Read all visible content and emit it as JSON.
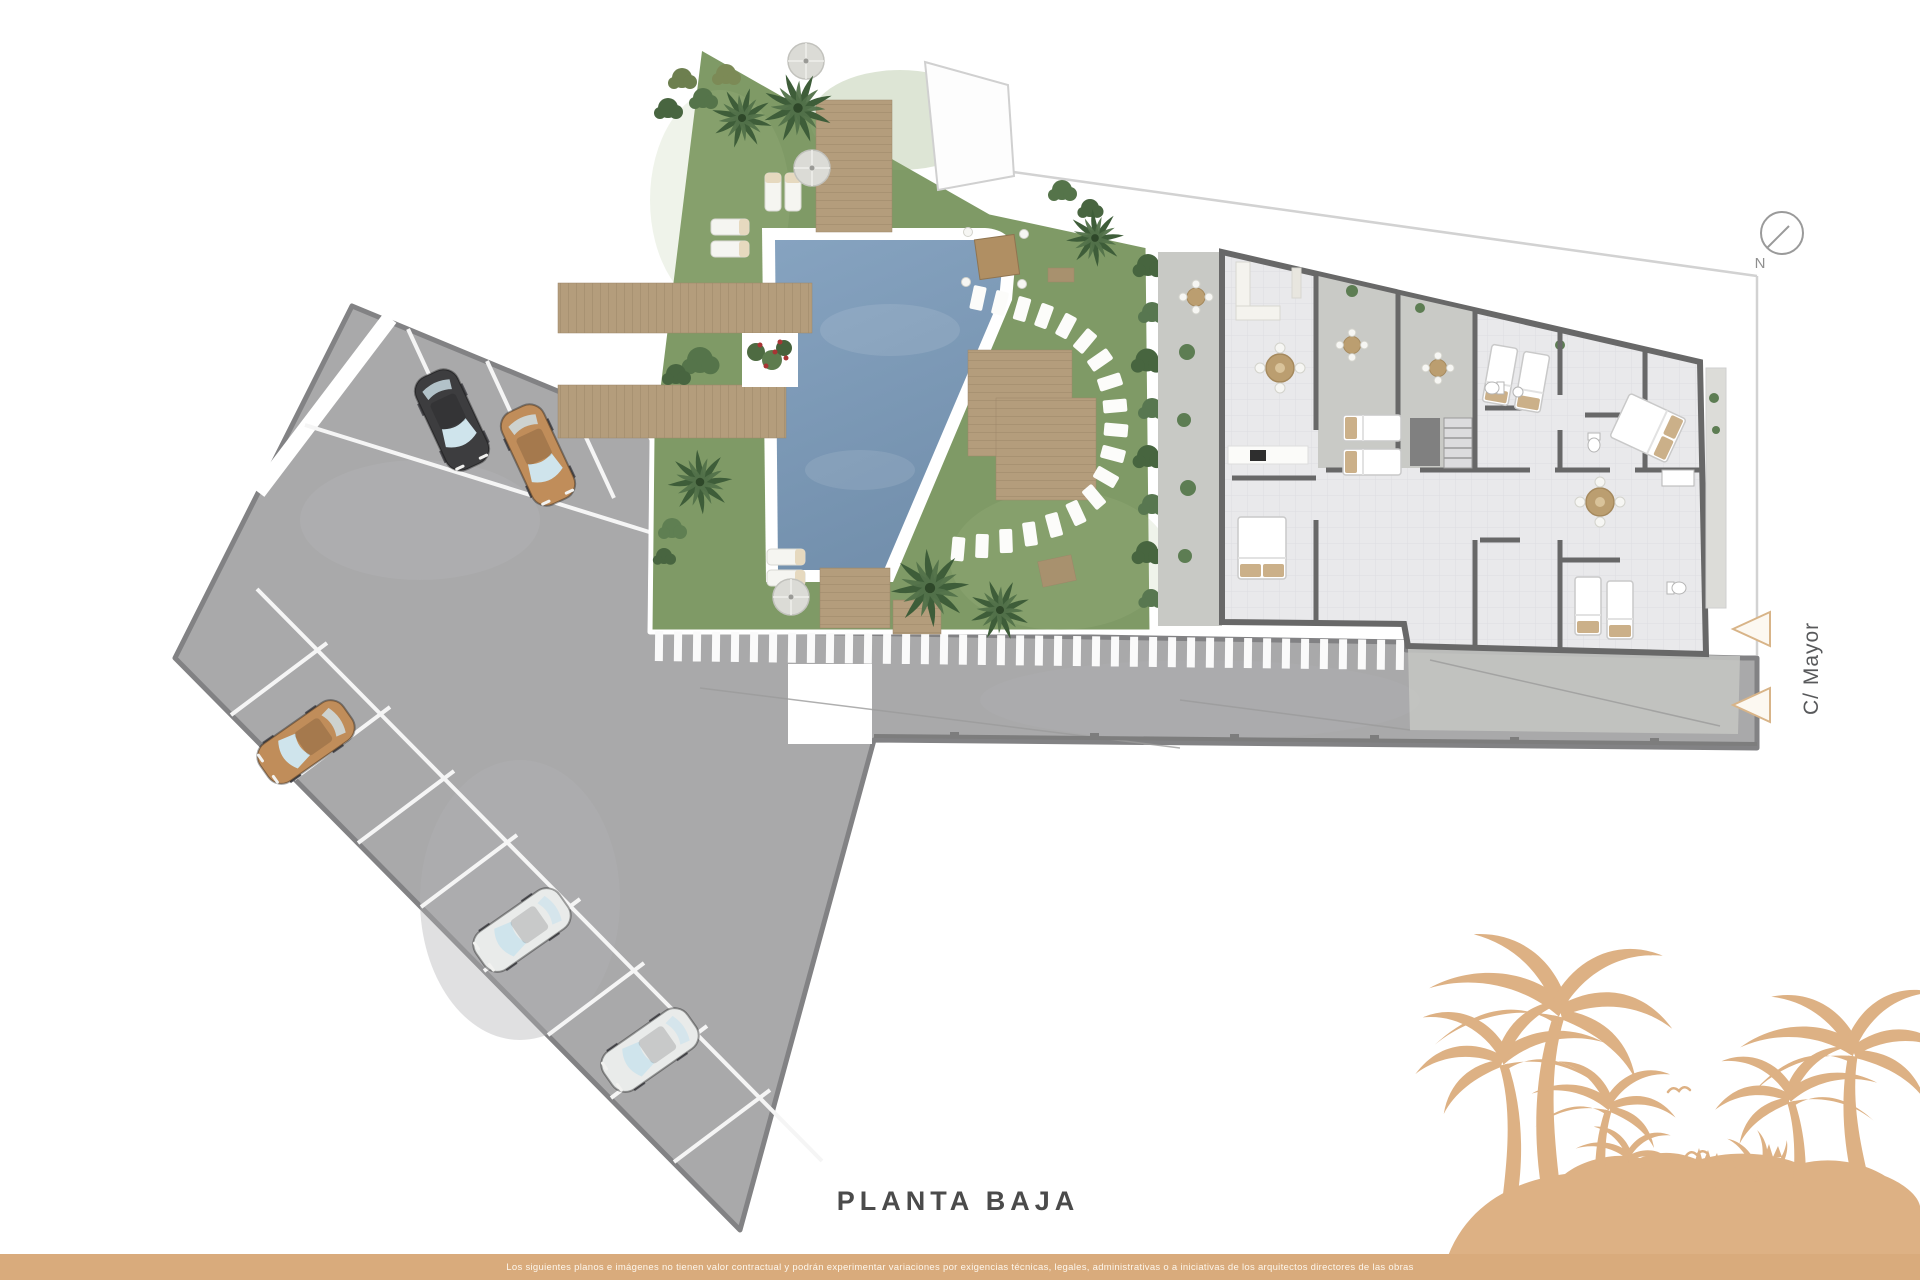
{
  "page": {
    "background_color": "#ffffff"
  },
  "labels": {
    "title": "PLANTA BAJA",
    "street": "C/ Mayor",
    "compass_north": "N"
  },
  "footer": {
    "disclaimer": "Los siguientes planos e imágenes no tienen valor contractual y podrán experimentar variaciones por exigencias técnicas, legales, administrativas o a iniciativas de los arquitectos directores de las obras",
    "bar_color": "#d9ab7c",
    "text_color": "#fdf6ec"
  },
  "decor": {
    "beach_silhouette_color": "#ddb184",
    "entrance_arrow_color": "#d8b488",
    "icons": [
      "palm-tree-icon",
      "seagull-icon",
      "compass-north-icon",
      "umbrella-icon",
      "entrance-arrow-icon"
    ]
  },
  "site": {
    "grass_color": "#7f9a66",
    "pool_color": "#7e9cba",
    "deck_color": "#b49d7c",
    "pavement_color": "#a9a9aa",
    "pavement_border_color": "#828284",
    "wall_color": "#686868",
    "floor_color": "#e9e9eb",
    "terrace_color": "#c8c9c5",
    "hedge_color": "#47653f",
    "cars": [
      {
        "name": "car-black-top-row",
        "color": "#3d3d3f"
      },
      {
        "name": "car-tan-top-row",
        "color": "#c08d5a"
      },
      {
        "name": "car-tan-left-row",
        "color": "#c08d5a"
      },
      {
        "name": "car-silver-bottom-1",
        "color": "#e9ebea"
      },
      {
        "name": "car-silver-bottom-2",
        "color": "#e9ebea"
      }
    ],
    "areas": [
      "parking-area",
      "garden-area",
      "pool",
      "building-floorplan",
      "street",
      "terrace-strip"
    ]
  }
}
